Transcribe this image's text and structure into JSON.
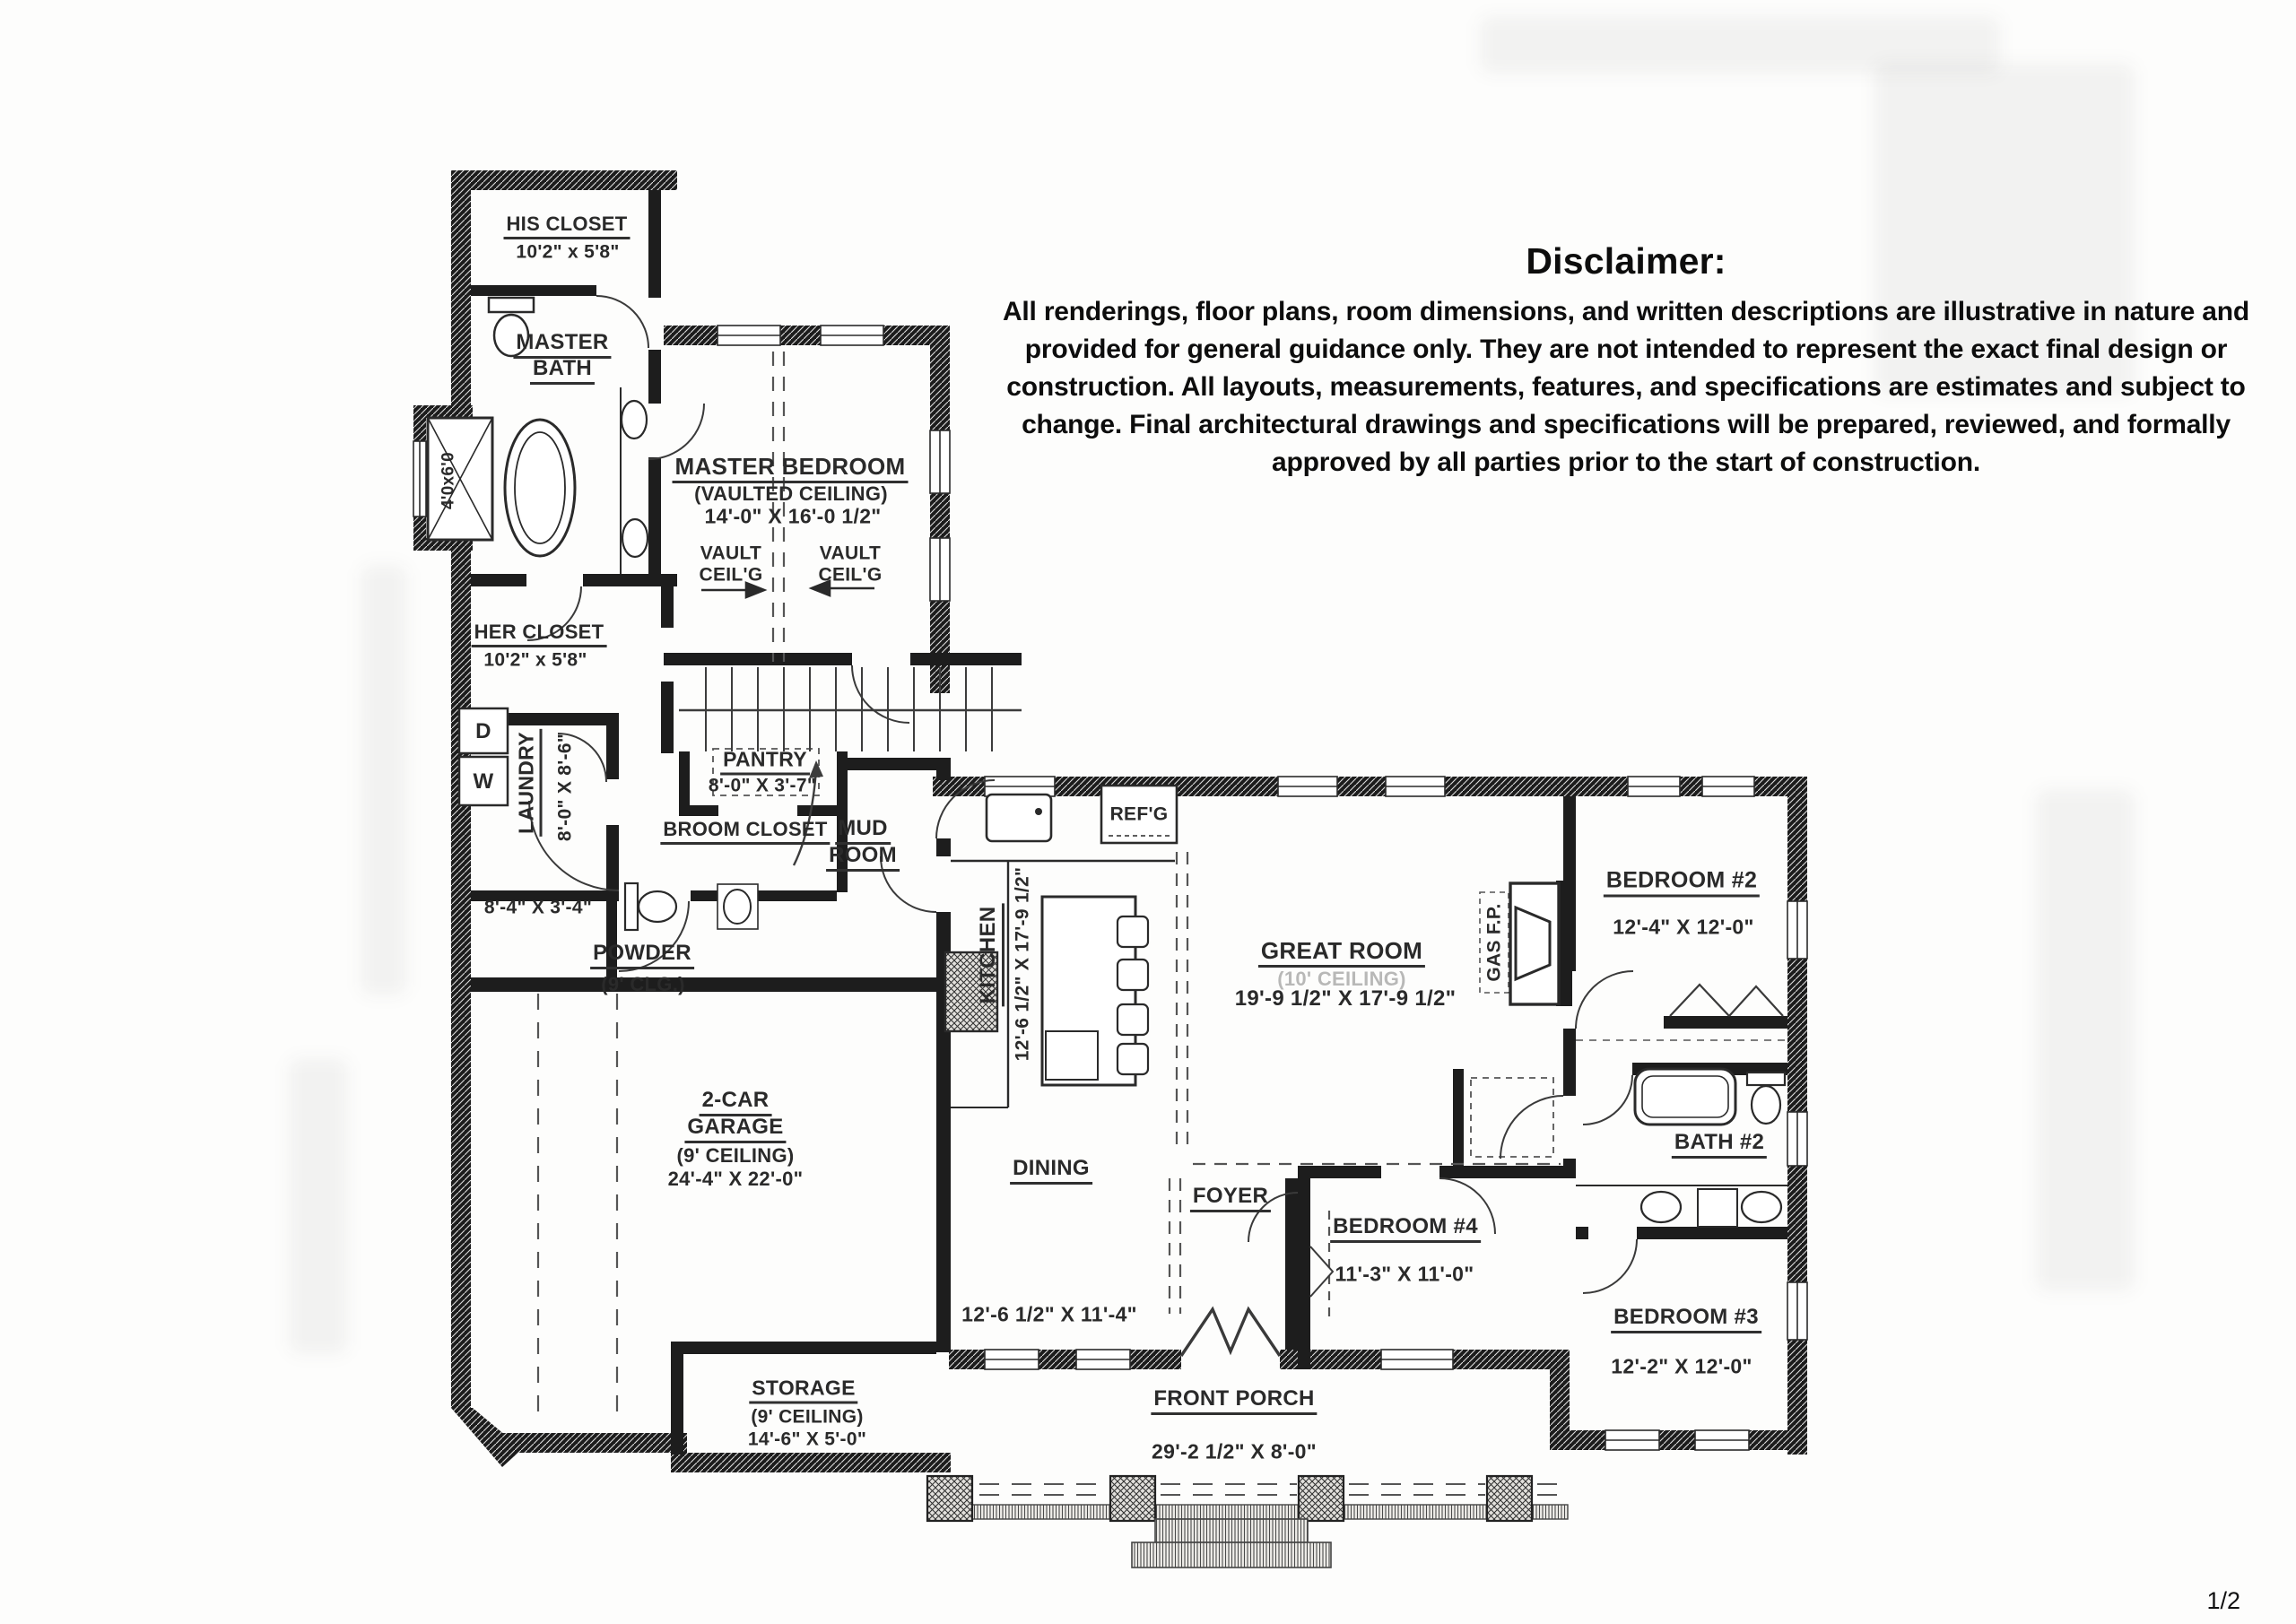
{
  "page": {
    "number": "1/2"
  },
  "disclaimer": {
    "title": "Disclaimer:",
    "body": "All renderings, floor plans, room dimensions, and written descriptions are illustrative in nature and provided for general guidance only. They are not intended to represent the exact final design or construction. All layouts, measurements, features, and specifications are estimates and subject to change. Final architectural drawings and specifications will be prepared, reviewed, and formally approved by all parties prior to the start of construction."
  },
  "rooms": {
    "his_closet": {
      "name": "HIS CLOSET",
      "dims": "10'2\" x 5'8\""
    },
    "master_bath": {
      "line1": "MASTER",
      "line2": "BATH"
    },
    "shower": {
      "dims": "4'0x6'0"
    },
    "master_bedroom": {
      "name": "MASTER BEDROOM",
      "ceiling": "(VAULTED CEILING)",
      "dims": "14'-0\" X 16'-0 1/2\""
    },
    "vault_note": {
      "line1": "VAULT",
      "line2": "CEIL'G"
    },
    "her_closet": {
      "name": "HER CLOSET",
      "dims": "10'2\" x 5'8\""
    },
    "laundry": {
      "name": "LAUNDRY",
      "dims": "8'-0\" X 8'-6\"",
      "dryer": "D",
      "washer": "W"
    },
    "pantry": {
      "name": "PANTRY",
      "dims": "8'-0\" X 3'-7\""
    },
    "broom_closet": {
      "name": "BROOM CLOSET"
    },
    "mud_room": {
      "line1": "MUD",
      "line2": "ROOM"
    },
    "hall_closet": {
      "dims": "8'-4\" X 3'-4\""
    },
    "powder": {
      "name": "POWDER",
      "ceiling": "(9' CLG.)"
    },
    "kitchen": {
      "name": "KITCHEN",
      "dims": "12'-6 1/2\" X 17'-9 1/2\""
    },
    "refrigerator": {
      "name": "REF'G"
    },
    "great_room": {
      "name": "GREAT ROOM",
      "ceiling": "(10' CEILING)",
      "dims": "19'-9 1/2\" X 17'-9 1/2\""
    },
    "gas_fireplace": {
      "name": "GAS F.P."
    },
    "bedroom2": {
      "name": "BEDROOM #2",
      "dims": "12'-4\" X 12'-0\""
    },
    "garage": {
      "line1": "2-CAR",
      "line2": "GARAGE",
      "ceiling": "(9' CEILING)",
      "dims": "24'-4\" X 22'-0\""
    },
    "dining": {
      "name": "DINING",
      "dims": "12'-6 1/2\" X 11'-4\""
    },
    "foyer": {
      "name": "FOYER"
    },
    "bedroom4": {
      "name": "BEDROOM #4",
      "dims": "11'-3\" X 11'-0\""
    },
    "bath2": {
      "name": "BATH #2"
    },
    "bedroom3": {
      "name": "BEDROOM #3",
      "dims": "12'-2\" X 12'-0\""
    },
    "storage": {
      "name": "STORAGE",
      "ceiling": "(9' CEILING)",
      "dims": "14'-6\" X 5'-0\""
    },
    "front_porch": {
      "name": "FRONT PORCH",
      "dims": "29'-2 1/2\" X 8'-0\""
    }
  }
}
